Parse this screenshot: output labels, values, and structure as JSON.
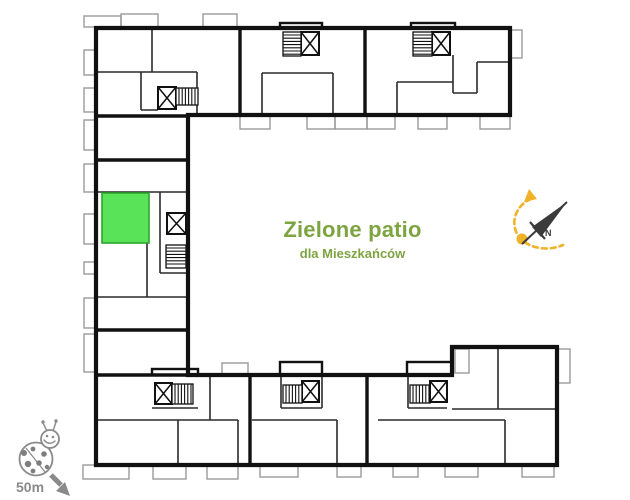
{
  "canvas": {
    "w": 630,
    "h": 500,
    "bg": "#ffffff"
  },
  "patio_label": {
    "title": "Zielone patio",
    "subtitle": "dla Mieszkańców",
    "color": "#7DA440"
  },
  "scale_marker": {
    "label": "50m",
    "icon": "ladybug-icon",
    "arrow_direction": "southeast",
    "color": "#8a8a8a"
  },
  "highlight_unit": {
    "x": 102,
    "y": 193,
    "w": 47,
    "h": 50,
    "fill": "#59E359",
    "stroke": "#2FA32F"
  },
  "floor_plan": {
    "wall_color": "#111111",
    "partition_color": "#2a2a2a",
    "balcony_color": "#9a9a9a",
    "outline": [
      [
        96,
        28
      ],
      [
        510,
        28
      ],
      [
        510,
        115
      ],
      [
        188,
        115
      ],
      [
        188,
        375
      ],
      [
        452,
        375
      ],
      [
        452,
        347
      ],
      [
        557,
        347
      ],
      [
        557,
        465
      ],
      [
        96,
        465
      ]
    ],
    "thick_walls": [
      [
        240,
        28,
        240,
        115
      ],
      [
        365,
        28,
        365,
        115
      ],
      [
        96,
        116,
        188,
        116
      ],
      [
        96,
        160,
        188,
        160
      ],
      [
        96,
        330,
        188,
        330
      ],
      [
        96,
        375,
        188,
        375
      ],
      [
        250,
        375,
        250,
        465
      ],
      [
        367,
        375,
        367,
        465
      ]
    ],
    "thin_walls": [
      [
        96,
        72,
        197,
        72
      ],
      [
        152,
        28,
        152,
        72
      ],
      [
        197,
        72,
        197,
        116
      ],
      [
        141,
        72,
        141,
        110
      ],
      [
        141,
        110,
        158,
        110
      ],
      [
        262,
        73,
        262,
        116
      ],
      [
        262,
        73,
        333,
        73
      ],
      [
        333,
        73,
        333,
        116
      ],
      [
        397,
        82,
        453,
        82
      ],
      [
        397,
        82,
        397,
        116
      ],
      [
        453,
        55,
        453,
        93
      ],
      [
        453,
        93,
        477,
        93
      ],
      [
        477,
        62,
        477,
        93
      ],
      [
        477,
        62,
        510,
        62
      ],
      [
        96,
        192,
        188,
        192
      ],
      [
        160,
        192,
        160,
        273
      ],
      [
        160,
        273,
        188,
        273
      ],
      [
        96,
        297,
        188,
        297
      ],
      [
        147,
        243,
        147,
        297
      ],
      [
        210,
        377,
        210,
        420
      ],
      [
        96,
        420,
        238,
        420
      ],
      [
        238,
        420,
        238,
        465
      ],
      [
        178,
        420,
        178,
        465
      ],
      [
        152,
        408,
        198,
        408
      ],
      [
        281,
        377,
        281,
        408
      ],
      [
        322,
        377,
        322,
        408
      ],
      [
        281,
        408,
        322,
        408
      ],
      [
        252,
        420,
        337,
        420
      ],
      [
        337,
        420,
        337,
        465
      ],
      [
        408,
        377,
        408,
        408
      ],
      [
        408,
        408,
        447,
        408
      ],
      [
        378,
        420,
        505,
        420
      ],
      [
        505,
        420,
        505,
        465
      ],
      [
        498,
        349,
        498,
        409
      ],
      [
        452,
        409,
        557,
        409
      ]
    ],
    "stair_bumps": [
      [
        280,
        23,
        42,
        5
      ],
      [
        411,
        23,
        44,
        5
      ],
      [
        152,
        369,
        46,
        6
      ],
      [
        280,
        362,
        42,
        13
      ],
      [
        407,
        362,
        45,
        13
      ]
    ],
    "stair_cores": [
      {
        "elevator": [
          158,
          87,
          18,
          22
        ],
        "stairs": [
          176,
          88,
          22,
          17
        ],
        "hatch": "v"
      },
      {
        "elevator": [
          301,
          32,
          18,
          23
        ],
        "stairs": [
          283,
          32,
          18,
          24
        ],
        "hatch": "h"
      },
      {
        "elevator": [
          432,
          32,
          18,
          23
        ],
        "stairs": [
          413,
          32,
          19,
          24
        ],
        "hatch": "h"
      },
      {
        "elevator": [
          167,
          213,
          19,
          21
        ],
        "stairs": [
          166,
          245,
          20,
          23
        ],
        "hatch": "h"
      },
      {
        "elevator": [
          155,
          383,
          17,
          21
        ],
        "stairs": [
          172,
          384,
          21,
          20
        ],
        "hatch": "v"
      },
      {
        "elevator": [
          302,
          381,
          17,
          21
        ],
        "stairs": [
          283,
          385,
          19,
          18
        ],
        "hatch": "v"
      },
      {
        "elevator": [
          430,
          381,
          17,
          21
        ],
        "stairs": [
          410,
          385,
          20,
          18
        ],
        "hatch": "v"
      }
    ],
    "balconies": [
      [
        84,
        16,
        37,
        11
      ],
      [
        121,
        14,
        37,
        14
      ],
      [
        203,
        14,
        34,
        14
      ],
      [
        84,
        50,
        12,
        25
      ],
      [
        84,
        88,
        12,
        24
      ],
      [
        84,
        120,
        12,
        30
      ],
      [
        84,
        164,
        12,
        28
      ],
      [
        84,
        214,
        12,
        30
      ],
      [
        84,
        262,
        12,
        12
      ],
      [
        84,
        298,
        12,
        30
      ],
      [
        84,
        334,
        12,
        38
      ],
      [
        510,
        30,
        12,
        28
      ],
      [
        557,
        349,
        13,
        34
      ],
      [
        455,
        349,
        14,
        24
      ],
      [
        240,
        116,
        30,
        13
      ],
      [
        307,
        116,
        28,
        13
      ],
      [
        335,
        116,
        32,
        13
      ],
      [
        367,
        116,
        28,
        13
      ],
      [
        418,
        116,
        29,
        13
      ],
      [
        480,
        116,
        30,
        13
      ],
      [
        222,
        363,
        26,
        12
      ],
      [
        83,
        465,
        46,
        14
      ],
      [
        153,
        466,
        33,
        13
      ],
      [
        207,
        466,
        31,
        13
      ],
      [
        260,
        465,
        38,
        12
      ],
      [
        337,
        465,
        24,
        12
      ],
      [
        393,
        465,
        25,
        12
      ],
      [
        445,
        465,
        33,
        12
      ],
      [
        522,
        465,
        32,
        12
      ]
    ]
  },
  "compass": {
    "label": "N",
    "color": "#3b3b3b",
    "sun_color": "#EFB229",
    "needle": [
      522,
      244,
      567,
      202
    ],
    "needle_fill": [
      [
        567,
        202
      ],
      [
        532,
        227
      ],
      [
        541,
        237
      ]
    ],
    "crossbar": [
      530,
      222,
      545,
      239
    ],
    "label_pos": [
      545,
      236
    ],
    "sun_path": "M 531 199 C 516 205 509 223 519 237 C 528 248 547 252 563 245",
    "sun_arrow": [
      [
        524,
        202
      ],
      [
        537,
        199
      ],
      [
        529,
        189
      ]
    ],
    "sun_dot": [
      522,
      239,
      5.5
    ]
  },
  "ladybug": {
    "color": "#8a8a8a",
    "spot_color": "#7e7e7e",
    "body": [
      36,
      459,
      16.5
    ],
    "head": [
      50,
      439,
      9
    ],
    "wing_line": [
      26,
      448,
      45,
      472
    ],
    "spots": [
      [
        24,
        453,
        3
      ],
      [
        33,
        449,
        2.4
      ],
      [
        44,
        454,
        2.8
      ],
      [
        28,
        464,
        3.2
      ],
      [
        39,
        463,
        2.8
      ],
      [
        47,
        467,
        2.2
      ],
      [
        33,
        471,
        2.4
      ]
    ],
    "eyes": [
      [
        47,
        436,
        1.3
      ],
      [
        53,
        437,
        1.3
      ]
    ],
    "smile": "M 44 440 Q 49 446 55 441",
    "antennae": [
      "M 47 431 L 43 423",
      "M 53 431 L 56 422"
    ],
    "antenna_dots": [
      [
        43,
        422,
        1.7
      ],
      [
        56,
        421,
        1.7
      ]
    ],
    "arrow_line": [
      51,
      475,
      61,
      485
    ],
    "arrow_head": [
      [
        56,
        491
      ],
      [
        65,
        482
      ],
      [
        70,
        496
      ]
    ]
  }
}
